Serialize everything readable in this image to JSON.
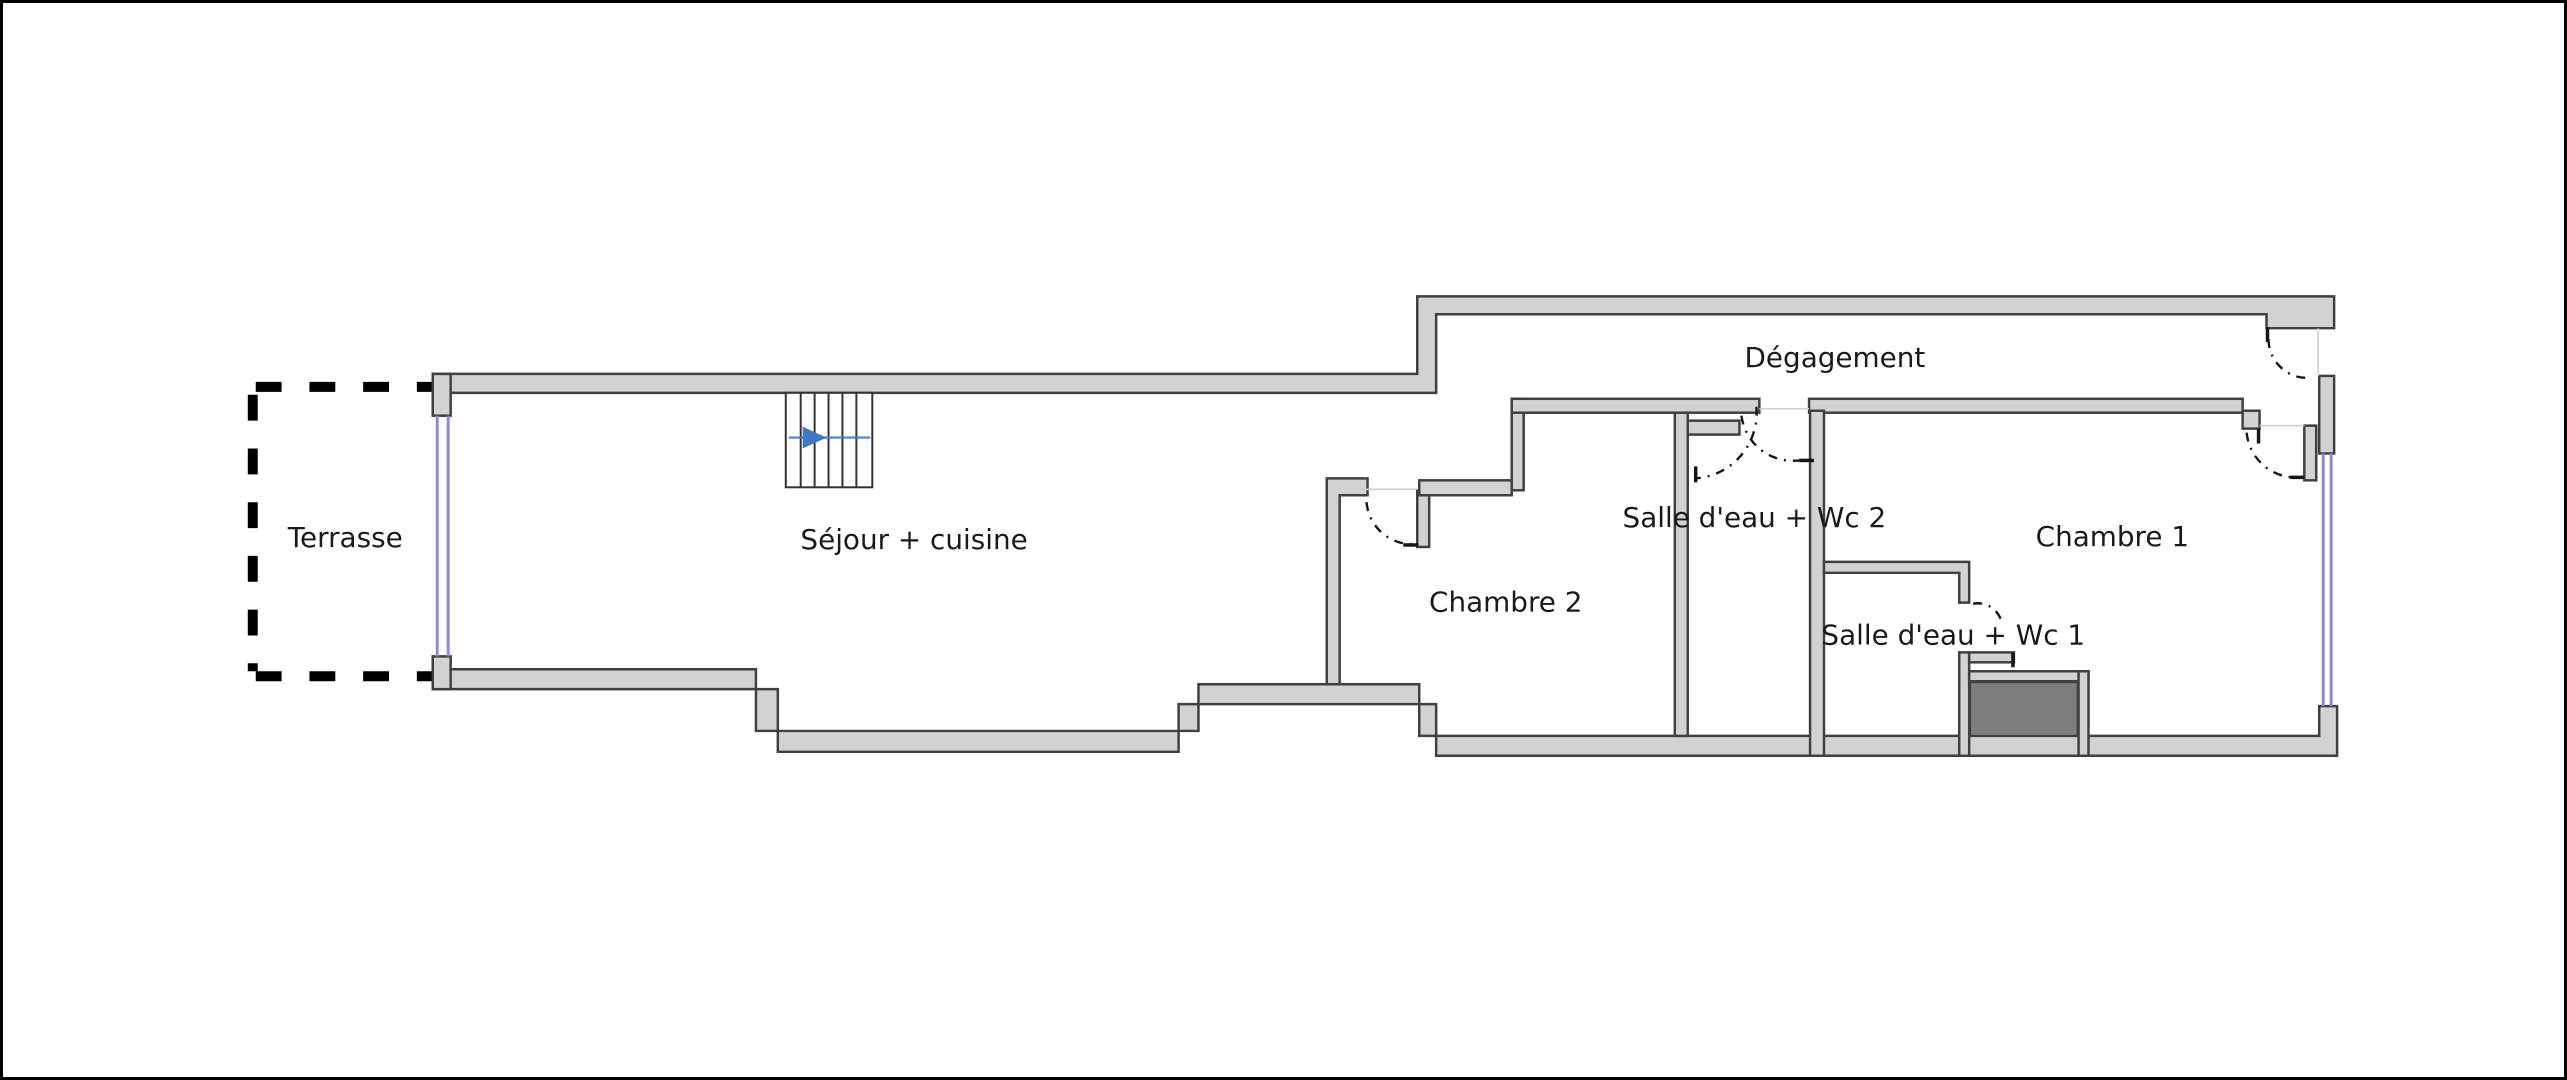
{
  "plan": {
    "type": "floor-plan",
    "rooms": [
      {
        "name": "terrasse",
        "label": "Terrasse"
      },
      {
        "name": "sejour-cuisine",
        "label": "Séjour + cuisine"
      },
      {
        "name": "chambre-2",
        "label": "Chambre 2"
      },
      {
        "name": "salle-eau-wc-2",
        "label": "Salle d'eau + Wc 2"
      },
      {
        "name": "degagement",
        "label": "Dégagement"
      },
      {
        "name": "chambre-1",
        "label": "Chambre 1"
      },
      {
        "name": "salle-eau-wc-1",
        "label": "Salle d'eau + Wc 1"
      }
    ],
    "colors": {
      "background": "#ffffff",
      "border": "#000000",
      "wall_fill": "#d2d2d2",
      "wall_outline": "#404040",
      "window": "#8e8cc8",
      "shower_fill": "#7e7e7e",
      "stair_arrow": "#4576c2",
      "terrace_dash": "#000000",
      "label_text": "#1a1a1a",
      "opening_line": "#cfcfcf"
    }
  }
}
